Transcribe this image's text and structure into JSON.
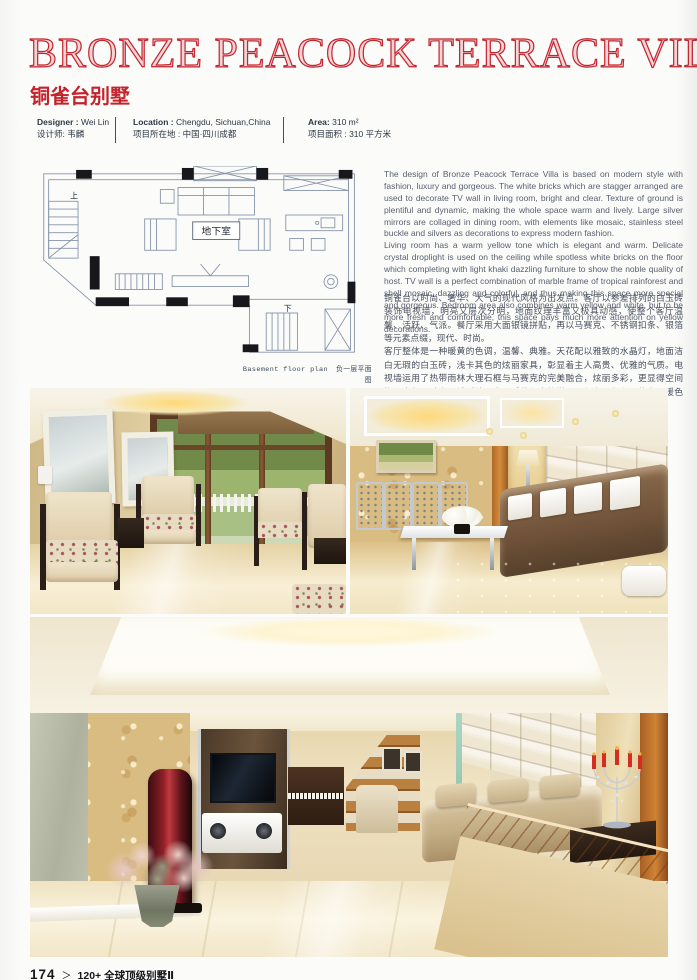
{
  "page": {
    "title": "BRONZE PEACOCK TERRACE VILLA",
    "subtitle_cn": "铜雀台别墅",
    "accent_color": "#c4232c"
  },
  "info": {
    "designer": {
      "label_en": "Designer :",
      "value_en": "Wei Lin",
      "line_cn": "设计师: 韦麟"
    },
    "location": {
      "label_en": "Location :",
      "value_en": "Chengdu, Sichuan,China",
      "line_cn": "项目所在地 : 中国·四川成都"
    },
    "area": {
      "label_en": "Area:",
      "value_en": "310 m²",
      "line_cn": "项目面积 : 310 平方米"
    }
  },
  "floor_plan": {
    "room_label": "地下室",
    "stairs_up_label": "上",
    "stairs_down_label": "下",
    "caption_en": "Basement floor plan",
    "caption_cn": "负一层平面图"
  },
  "description": {
    "english": "The design of Bronze Peacock Terrace Villa is based on modern style with fashion, luxury and gorgeous. The white bricks which are stagger arranged are used to decorate TV wall in living room, bright and clear. Texture of ground is plentiful and dynamic, making the whole space warm and lively. Large silver mirrors are collaged in dining room, with elements like mosaic, stainless steel buckle and silvers as decorations to express modern fashion.\nLiving room has a warm yellow tone which is elegant and warm. Delicate crystal droplight is used on the ceiling while spotless white bricks on the floor which completing with light khaki dazzling furniture to show the noble quality of host. TV wall is a perfect combination of marble frame of tropical rainforest and shell mosaic, dazzling and colorful, and thus making this space more special and gorgeous. Bedroom area also combines warm yellow and white, but to be more fresh and comfortable, this space pays much more attention on yellow decorations.",
    "chinese": "铜雀台以时尚、奢华、大气的现代风格为出发点。客厅以参差排列的白玉砖装饰电视墙，明亮又层次分明，地面纹理丰富又极具动感，使整个客厅温馨、活跃、气派。餐厅采用大面银镜拼贴，再以马赛克、不锈钢扣条、银箔等元素点缀，现代、时尚。\n客厅整体是一种暖黄的色调，温馨、典雅。天花配以雅致的水晶灯，地面洁白无瑕的白玉砖，浅卡其色的炫丽家具，彰显着主人高贵、优雅的气质。电视墙运用了热带雨林大理石框与马赛克的完美融合，炫丽多彩，更显得空间恢弘大气。卧房区域延续了客厅暖黄与白的搭配，但在配色上更偏向于暖色调，使空间变得优雅、清新、温馨、舒适。"
  },
  "footer": {
    "page_number": "174",
    "separator": "＞",
    "book_title": "120+ 全球顶级别墅Ⅱ"
  }
}
